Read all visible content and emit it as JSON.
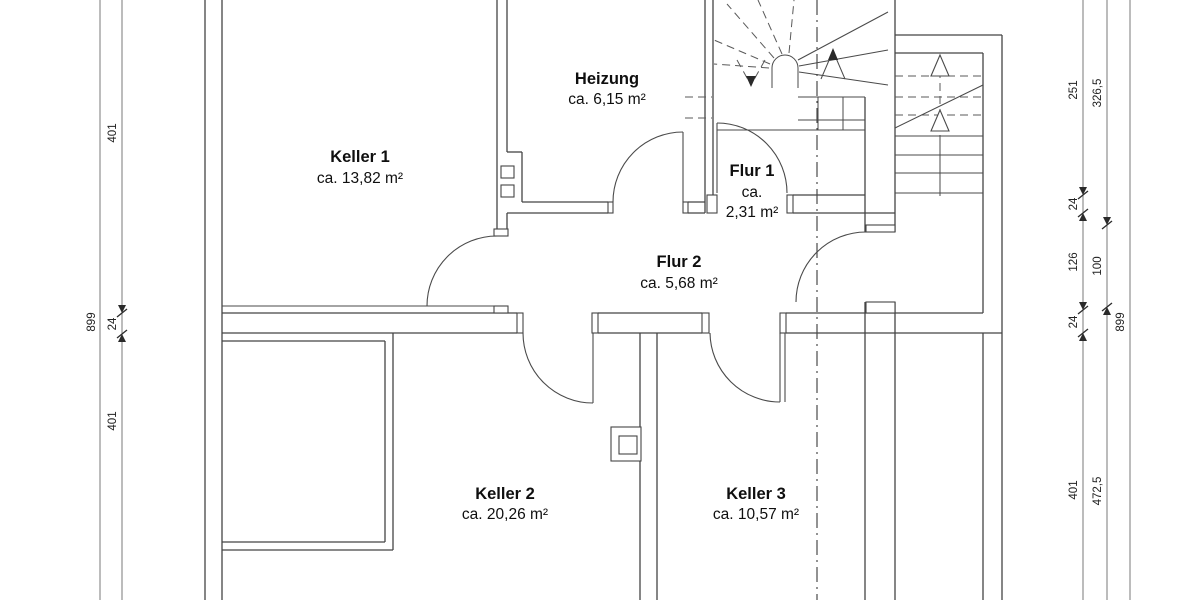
{
  "title": "Kellergeschoss Grundriss",
  "rooms": {
    "keller1": {
      "name": "Keller 1",
      "area": "ca. 13,82 m²"
    },
    "heizung": {
      "name": "Heizung",
      "area": "ca. 6,15 m²"
    },
    "flur1": {
      "name": "Flur 1",
      "area_line1": "ca.",
      "area_line2": "2,31 m²"
    },
    "flur2": {
      "name": "Flur 2",
      "area": "ca. 5,68 m²"
    },
    "keller2": {
      "name": "Keller 2",
      "area": "ca. 20,26 m²"
    },
    "keller3": {
      "name": "Keller 3",
      "area": "ca. 10,57 m²"
    }
  },
  "dimensions": {
    "left_overall": "899",
    "left_chain": {
      "top": "401",
      "middle": "24",
      "bottom": "401"
    },
    "right_chain_inner": {
      "top": "251",
      "second": "24",
      "third": "126",
      "fourth": "24",
      "bottom": "401"
    },
    "right_chain_middle": {
      "top": "326,5",
      "middle": "100",
      "bottom": "472,5"
    },
    "right_overall": "899"
  },
  "colors": {
    "wall_line": "#454545",
    "dimension_line": "#7a7a7a",
    "label_text": "#0f0f0f",
    "dimension_text": "#222222",
    "background": "#ffffff"
  }
}
